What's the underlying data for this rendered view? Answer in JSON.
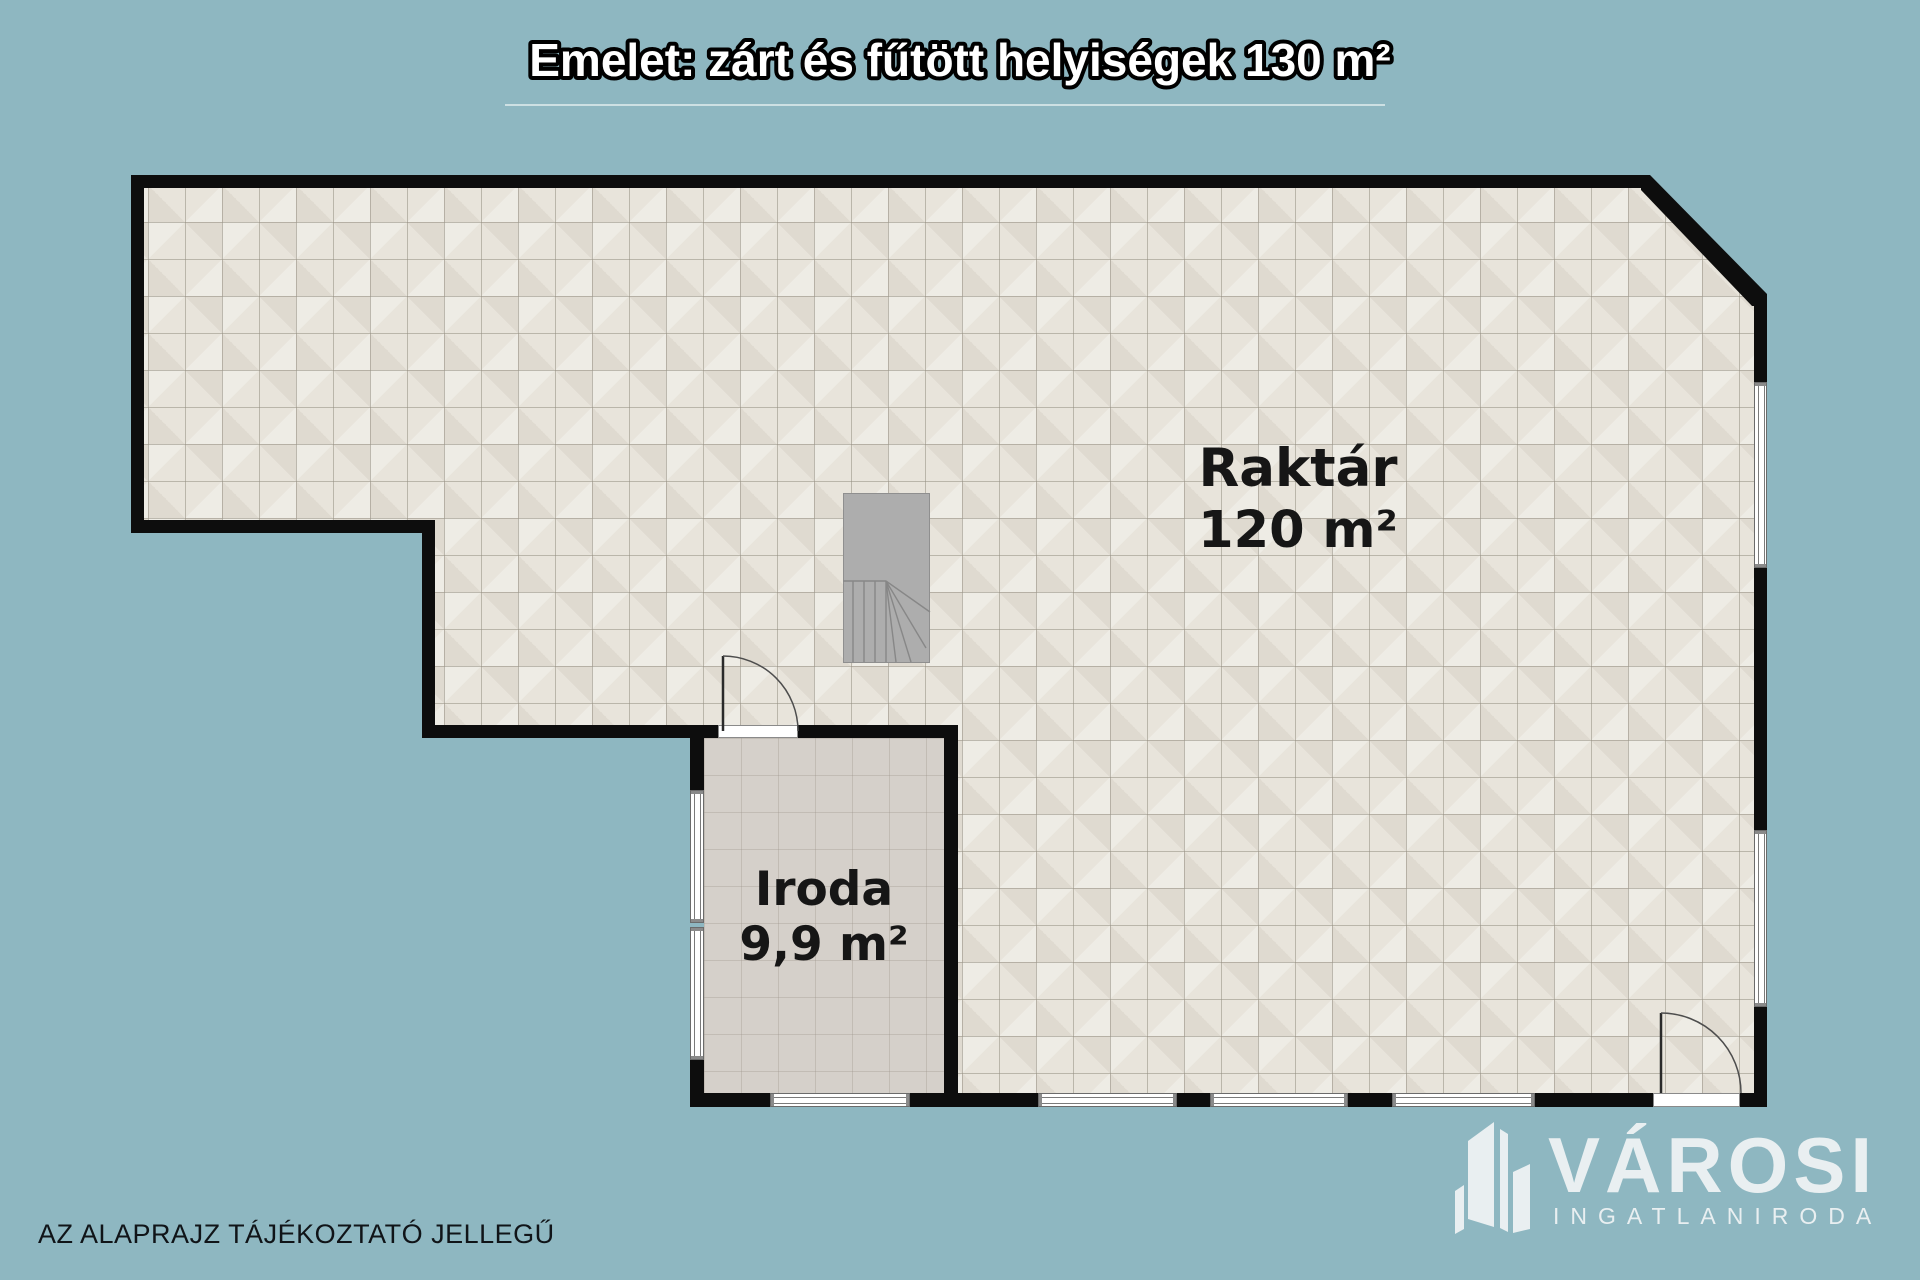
{
  "title": {
    "text": "Emelet: zárt és fűtött helyiségek 130 m²"
  },
  "rooms": [
    {
      "name": "Raktár",
      "area": "120 m²"
    },
    {
      "name": "Iroda",
      "area": "9,9 m²"
    }
  ],
  "footnote": {
    "text": "AZ ALAPRAJZ TÁJÉKOZTATÓ JELLEGŰ"
  },
  "logo": {
    "name": "VÁROSI",
    "subtitle": "INGATLANIRODA"
  },
  "colors": {
    "background": "#8eb7c1",
    "wall": "#0d0d0d",
    "warehouse_floor": "#e8e4db",
    "office_floor": "#d5d0ca",
    "stairs": "#adadad",
    "label_text": "#161616",
    "title_fill": "#ffffff",
    "title_outline": "#000000",
    "logo_text": "#e9eff1"
  }
}
